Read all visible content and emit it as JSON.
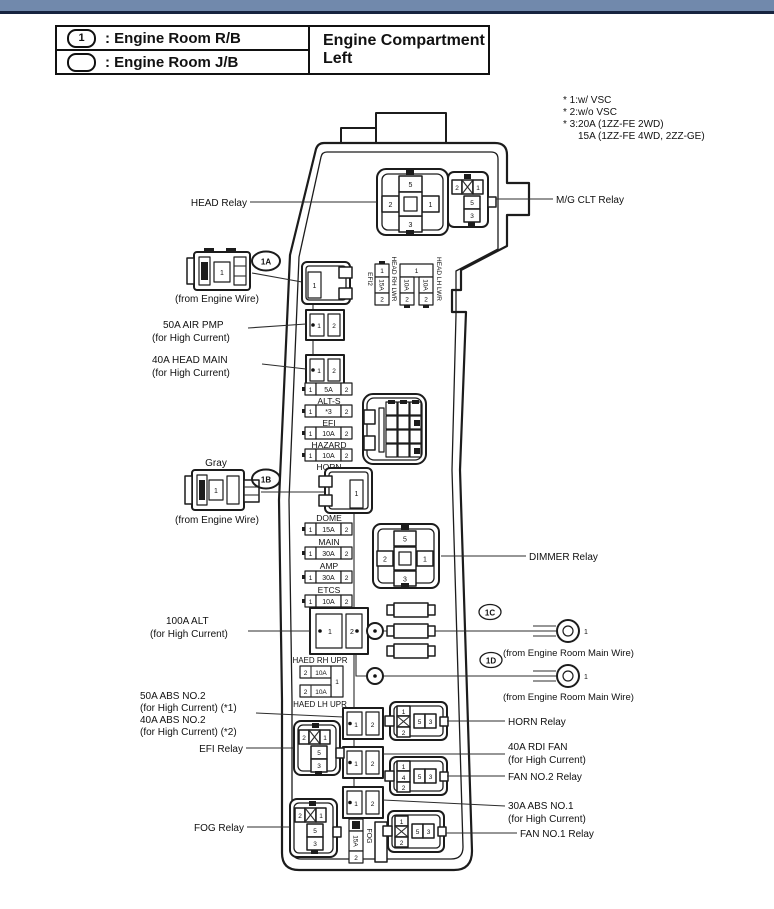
{
  "page": {
    "accent_bar_color": "#7189ac",
    "accent_bar_edge_color": "#16233f",
    "line_color": "#1c1c1c"
  },
  "header": {
    "title": "Engine Compartment Left",
    "legend": [
      {
        "symbol": "1",
        "label": ": Engine Room R/B"
      },
      {
        "symbol": "",
        "label": ": Engine Room J/B"
      }
    ]
  },
  "notes": [
    "* 1:w/ VSC",
    "* 2:w/o VSC",
    "* 3:20A (1ZZ-FE 2WD)",
    "15A (1ZZ-FE 4WD, 2ZZ-GE)"
  ],
  "refs": {
    "a": "1A",
    "b": "1B",
    "c": "1C",
    "d": "1D"
  },
  "callouts": {
    "head_relay": "HEAD Relay",
    "mg_clt_relay": "M/G CLT Relay",
    "from_engine_wire_a": "(from Engine Wire)",
    "air_pmp_line1": "50A AIR PMP",
    "air_pmp_line2": "(for High Current)",
    "head_main_line1": "40A HEAD MAIN",
    "head_main_line2": "(for High Current)",
    "gray": "Gray",
    "from_engine_wire_b": "(from Engine Wire)",
    "dimmer_relay": "DIMMER Relay",
    "alt_line1": "100A ALT",
    "alt_line2": "(for High Current)",
    "from_main_wire_c": "(from Engine Room Main Wire)",
    "from_main_wire_d": "(from Engine Room Main Wire)",
    "abs2_line1": "50A ABS NO.2",
    "abs2_line2": "(for High Current) (*1)",
    "abs2_line3": "40A ABS NO.2",
    "abs2_line4": "(for High Current) (*2)",
    "efi_relay": "EFI Relay",
    "fog_relay": "FOG Relay",
    "horn_relay": "HORN Relay",
    "rdi_fan_line1": "40A RDI FAN",
    "rdi_fan_line2": "(for High Current)",
    "fan2_relay": "FAN NO.2 Relay",
    "abs1_line1": "30A ABS NO.1",
    "abs1_line2": "(for High Current)",
    "fan1_relay": "FAN NO.1 Relay"
  },
  "relays": {
    "head": {
      "top": "5",
      "left": "2",
      "right": "1",
      "bottom": "3"
    },
    "dimmer": {
      "top": "5",
      "left": "2",
      "right": "1",
      "bottom": "3"
    },
    "mg_clt": {
      "tl": "2",
      "tr": "1",
      "mid": "5",
      "bot": "3"
    },
    "efi": {
      "tl": "2",
      "tr": "1",
      "mid": "5",
      "bot": "3"
    },
    "fog": {
      "tl": "2",
      "tr": "1",
      "mid": "5",
      "bot": "3"
    },
    "horn": {
      "s1": "1",
      "s2": "2",
      "r1": "5",
      "r2": "3"
    },
    "fan2": {
      "s1": "1",
      "s2": "4",
      "s3": "2",
      "r1": "5",
      "r2": "3"
    },
    "fan1": {
      "s1": "1",
      "s2": "2",
      "r1": "5",
      "r2": "3"
    }
  },
  "top_strip": {
    "efi2_label": "EFI2",
    "efi2_fuse": {
      "p1": "1",
      "amp": "15A",
      "p2": "2"
    },
    "head_rh_lwr": "HEAD RH LWR",
    "shared_pin": "1",
    "lwr_fuse1": {
      "amp": "10A",
      "p2": "2"
    },
    "lwr_fuse2": {
      "amp": "10A",
      "p2": "2"
    },
    "head_lh_lwr": "HEAD LH LWR"
  },
  "fuse_col_a": [
    {
      "p1": "1",
      "amp": "5A",
      "p2": "2",
      "label": "ALT-S"
    },
    {
      "p1": "1",
      "amp": "*3",
      "p2": "2",
      "label": "EFI"
    },
    {
      "p1": "1",
      "amp": "10A",
      "p2": "2",
      "label": "HAZARD"
    },
    {
      "p1": "1",
      "amp": "10A",
      "p2": "2",
      "label": "HORN"
    }
  ],
  "fuse_col_b": [
    {
      "label": "DOME",
      "p1": "1",
      "amp": "15A",
      "p2": "2"
    },
    {
      "label": "MAIN",
      "p1": "1",
      "amp": "30A",
      "p2": "2"
    },
    {
      "label": "AMP",
      "p1": "1",
      "amp": "30A",
      "p2": "2"
    },
    {
      "label": "ETCS",
      "p1": "1",
      "amp": "10A",
      "p2": "2"
    }
  ],
  "hc_fuses": {
    "air_pmp": {
      "p1": "1",
      "p2": "2"
    },
    "head_main": {
      "p1": "1",
      "p2": "2"
    },
    "alt": {
      "p1": "1",
      "p2": "2"
    },
    "abs2": {
      "p1": "1",
      "p2": "2"
    },
    "rdi_fan": {
      "p1": "1",
      "p2": "2"
    },
    "abs1": {
      "p1": "1",
      "p2": "2"
    }
  },
  "haed_group": {
    "top_label": "HAED RH UPR",
    "fuse1": {
      "p2": "2",
      "amp": "10A"
    },
    "shared_pin": "1",
    "fuse2": {
      "p2": "2",
      "amp": "10A"
    },
    "bottom_label": "HAED LH UPR"
  },
  "fog_fuse": {
    "amp": "15A",
    "p2": "2",
    "label": "FOG"
  },
  "connectors": {
    "wire_a_pin": "1",
    "box_a_pin": "1",
    "wire_b_pin": "1",
    "box_b_pin": "1",
    "ring_c_pin": "1",
    "ring_d_pin": "1"
  }
}
